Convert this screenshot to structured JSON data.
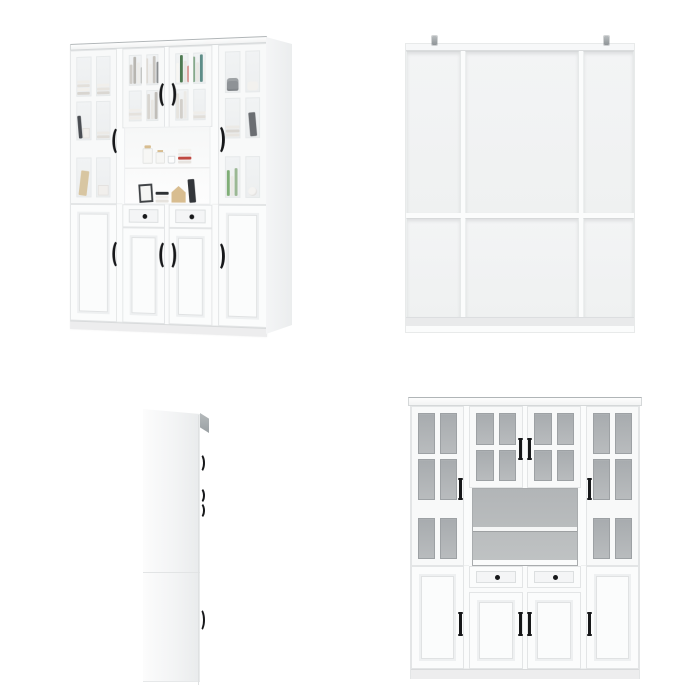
{
  "image": {
    "background": "#ffffff",
    "type": "product-gallery",
    "item": "white glass-door bookcase hutch cabinet"
  },
  "views": [
    {
      "id": "front-styled",
      "label": "Styled front three-quarter view with decor"
    },
    {
      "id": "back",
      "label": "Back panel view with anti-tip brackets"
    },
    {
      "id": "side",
      "label": "Side profile view"
    },
    {
      "id": "front",
      "label": "Front elevation view, empty"
    }
  ],
  "counts": {
    "upper_glass_doors": 4,
    "lower_doors": 4,
    "drawers": 2,
    "open_shelves": 2,
    "anti_tip_brackets": 2
  },
  "palette": {
    "cabinetWhite": "#fbfcfc",
    "frameLine": "#e3e5e6",
    "paneGrayTop": "#a7abae",
    "paneGrayBottom": "#b9bcbe",
    "interiorTop": "#b2b5b7",
    "interiorBottom": "#c0c3c4",
    "glassTintTop": "#f1f3f4",
    "glassTintBottom": "#eceeef",
    "handleBlack": "#17181a",
    "woodTan": "#d8bd90",
    "basketGray": "#8e9296",
    "backPanelTop": "#f3f4f5",
    "backPanelBottom": "#eff1f1",
    "baseStrip": "#e9eaeb",
    "corniceEdge": "#b0b5b7",
    "sideFaceLight": "#fcfcfc",
    "sideFaceDark": "#e9ebec",
    "plinth": "#ededee"
  },
  "cabinet": {
    "doors": {
      "photo_left": {
        "cols": 2,
        "rows": 3,
        "glass": "photo",
        "rail": true,
        "panes": {
          "0": [
            {
              "t": "stack",
              "colors": [
                "#efede9",
                "#e3e0db",
                "#f2f0ec",
                "#d8d5d0"
              ]
            }
          ],
          "1": [
            {
              "t": "stack",
              "colors": [
                "#f1efeb",
                "#e7e4df",
                "#dad7d2"
              ]
            }
          ],
          "2": [
            {
              "t": "book",
              "color": "#4a4d52"
            },
            {
              "t": "box",
              "color": "#f0eeea"
            }
          ],
          "3": [
            {
              "t": "stack",
              "colors": [
                "#eceae6",
                "#e0ddd8"
              ]
            }
          ],
          "4": [
            {
              "t": "board",
              "color": "#d8c6a2"
            }
          ],
          "5": [
            {
              "t": "box",
              "color": "#f1efec"
            }
          ]
        }
      },
      "photo_mid_left": {
        "cols": 2,
        "rows": 2,
        "glass": "photo",
        "panes": {
          "0": [
            {
              "t": "spines",
              "colors": [
                "#e9e7e2",
                "#cfccc7",
                "#b8b6b1",
                "#eeedea",
                "#a9aba9"
              ]
            }
          ],
          "1": [
            {
              "t": "spines",
              "colors": [
                "#dedbd6",
                "#efeeeb",
                "#c7c4bf",
                "#8b8e90"
              ]
            }
          ],
          "2": [
            {
              "t": "stack",
              "colors": [
                "#f0eeea",
                "#e5e2dd",
                "#efede9"
              ]
            }
          ],
          "3": [
            {
              "t": "spines",
              "colors": [
                "#d8d5d0",
                "#e9e7e3",
                "#c0bdb8"
              ]
            }
          ]
        }
      },
      "photo_mid_right": {
        "cols": 2,
        "rows": 2,
        "glass": "photo",
        "panes": {
          "0": [
            {
              "t": "spines",
              "colors": [
                "#74a169",
                "#f7f6f3",
                "#4e7a52",
                "#e9e7e2",
                "#bf4840"
              ]
            }
          ],
          "1": [
            {
              "t": "spines",
              "colors": [
                "#86a98c",
                "#e9e8e4",
                "#5e8d88",
                "#f0efec"
              ]
            }
          ],
          "2": [
            {
              "t": "spines",
              "colors": [
                "#e6e4df",
                "#d2cfca",
                "#eceae6"
              ]
            }
          ],
          "3": [
            {
              "t": "stack",
              "colors": [
                "#efede9",
                "#e2dfda"
              ]
            }
          ]
        }
      },
      "photo_right": {
        "cols": 2,
        "rows": 3,
        "glass": "photo",
        "rail": true,
        "panes": {
          "0": [
            {
              "t": "basket",
              "color": "#8e9296"
            }
          ],
          "1": [
            {
              "t": "cloth",
              "color": "#f2f1ee"
            }
          ],
          "2": [
            {
              "t": "stack",
              "colors": [
                "#eceae6",
                "#dad7d2",
                "#e8e5e0"
              ]
            }
          ],
          "3": [
            {
              "t": "book",
              "color": "#6b6e72"
            }
          ],
          "4": [
            {
              "t": "spines",
              "colors": [
                "#7fae76",
                "#ebe9e5",
                "#9bb894"
              ]
            }
          ],
          "5": [
            {
              "t": "sphere",
              "color": "#f4f3f1"
            }
          ]
        }
      },
      "front_left": {
        "cols": 2,
        "rows": 3,
        "glass": "gray",
        "rail": true
      },
      "front_mid_left": {
        "cols": 2,
        "rows": 2,
        "glass": "gray"
      },
      "front_mid_right": {
        "cols": 2,
        "rows": 2,
        "glass": "gray"
      },
      "front_right": {
        "cols": 2,
        "rows": 3,
        "glass": "gray",
        "rail": true
      }
    },
    "shelves": {
      "upper": [
        {
          "t": "jar"
        },
        {
          "t": "can"
        },
        {
          "t": "cup"
        },
        {
          "t": "stack",
          "colors": [
            "#f4f3f0",
            "#ece9e5",
            "#bf4840",
            "#e7e4e0"
          ]
        }
      ],
      "lower": [
        {
          "t": "frame"
        },
        {
          "t": "stack",
          "colors": [
            "#2e3134",
            "#f1efec",
            "#e6e3de"
          ]
        },
        {
          "t": "house"
        },
        {
          "t": "book",
          "color": "#33363a"
        }
      ]
    }
  }
}
